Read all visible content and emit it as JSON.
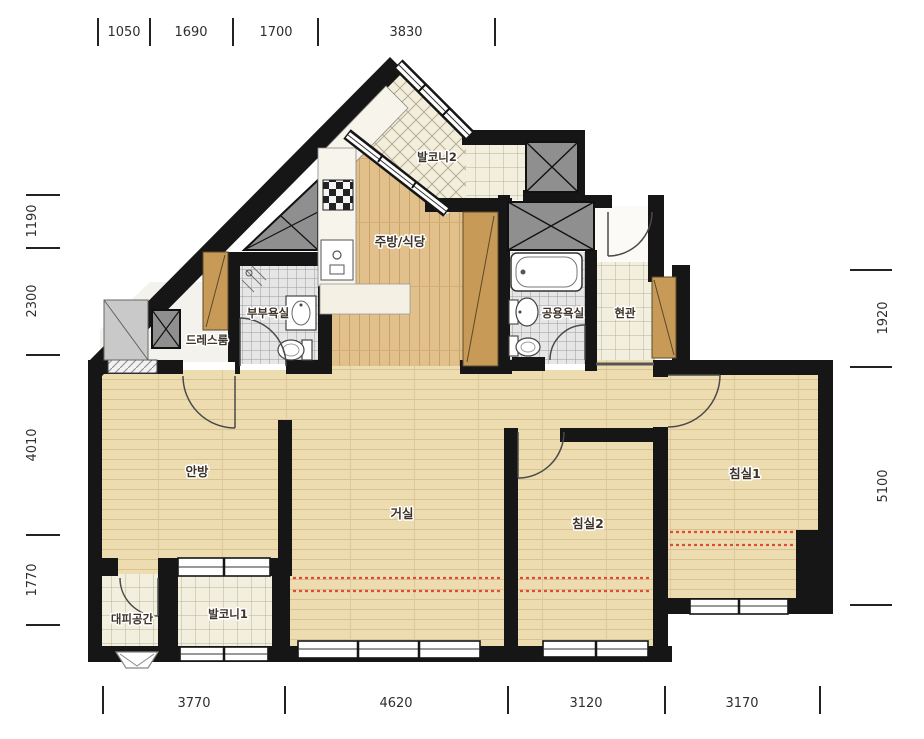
{
  "plan": {
    "title": "apartment-floor-plan",
    "rooms": {
      "balcony2": "발코니2",
      "kitchen": "주방/식당",
      "master_bath": "부부욕실",
      "dressroom": "드레스룸",
      "common_bath": "공용욕실",
      "entrance": "현관",
      "master_bedroom": "안방",
      "living": "거실",
      "bedroom2": "침실2",
      "bedroom1": "침실1",
      "shelter": "대피공간",
      "balcony1": "발코니1"
    },
    "dims": {
      "top": [
        "1050",
        "1690",
        "1700",
        "3830"
      ],
      "bottom": [
        "3770",
        "4620",
        "3120",
        "3170"
      ],
      "left": [
        "1190",
        "2300",
        "4010",
        "1770"
      ],
      "right": [
        "1920",
        "5100"
      ]
    },
    "colors": {
      "wall": "#161616",
      "wood": "#ecdcb0",
      "kitchen_wood": "#e2c08c",
      "balcony_tile": "#f3efdf",
      "bath_tile": "#e6e6e6",
      "cabinet": "#c89a58",
      "duct": "#8f8f8f",
      "expansion_dash": "#df4b38"
    }
  }
}
